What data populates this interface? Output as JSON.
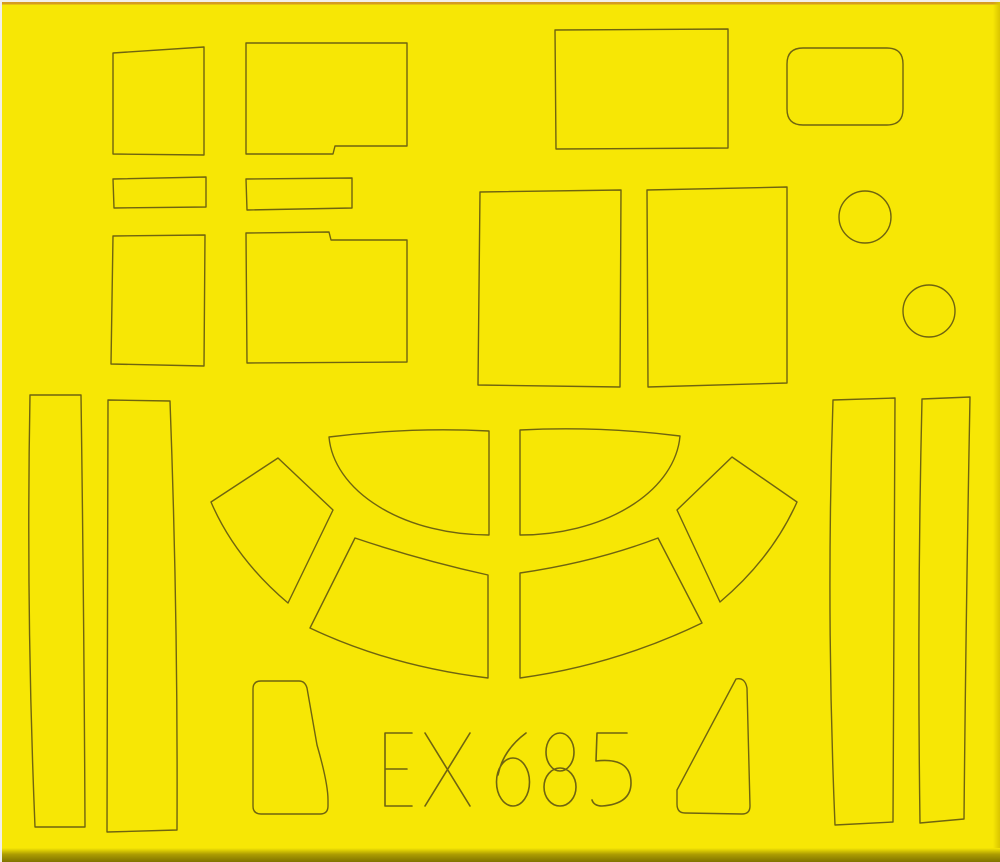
{
  "product_code": "EX685",
  "colors": {
    "background": "#f2efe8",
    "sheet_yellow": "#f7e705",
    "cut_line": "#6f6410",
    "top_accent": "#cd8a26",
    "right_edge_shade": "#d9c500",
    "bottom_edge_mid": "#ac9d02",
    "bottom_edge_dark": "#7f7300"
  },
  "sheet": {
    "width": 1000,
    "height": 862,
    "shapes": [
      {
        "name": "mask-quad-top-left",
        "type": "path",
        "d": "M113,53 L204,47 L204,155 L113,154 Z"
      },
      {
        "name": "mask-rect-notched-top",
        "type": "path",
        "d": "M246,43 L407,43 L407,146 L335,146 L333,154 L246,154 Z"
      },
      {
        "name": "mask-strip-small-left",
        "type": "path",
        "d": "M113,179 L206,177 L206,207 L114,208 Z"
      },
      {
        "name": "mask-strip-small-right",
        "type": "path",
        "d": "M246,179 L352,178 L352,208 L247,210 Z"
      },
      {
        "name": "mask-rect-mid-left",
        "type": "path",
        "d": "M113,236 L205,235 L204,366 L111,364 Z"
      },
      {
        "name": "mask-rect-notched-bottom",
        "type": "path",
        "d": "M246,233 L329,232 L331,240 L407,240 L407,362 L247,363 Z"
      },
      {
        "name": "mask-rect-top-center",
        "type": "path",
        "d": "M555,30 L728,29 L728,148 L556,149 Z"
      },
      {
        "name": "mask-rounded-rect",
        "type": "path",
        "d": "M803,48 L887,48 Q903,48 903,64 L903,109 Q903,125 887,125 L803,125 Q787,125 787,109 L787,64 Q787,48 803,48 Z"
      },
      {
        "name": "mask-rect-center-left",
        "type": "path",
        "d": "M480,192 L621,190 L620,387 L478,385 Z"
      },
      {
        "name": "mask-rect-center-right",
        "type": "path",
        "d": "M647,190 L787,187 L787,383 L648,387 Z"
      },
      {
        "name": "mask-circle-upper",
        "type": "circle",
        "cx": 865,
        "cy": 217,
        "r": 26
      },
      {
        "name": "mask-circle-lower",
        "type": "circle",
        "cx": 929,
        "cy": 311,
        "r": 26
      },
      {
        "name": "mask-canopy-inner-left",
        "type": "path",
        "d": "M329,437 Q409,427 489,431 L489,535 A160,104 0 0 1 329,437 Z"
      },
      {
        "name": "mask-canopy-inner-right",
        "type": "path",
        "d": "M520,430 Q600,426 680,436 A160,105 0 0 1 520,535 Z"
      },
      {
        "name": "mask-canopy-outer-left",
        "type": "path",
        "d": "M355,538 Q420,560 488,575 L488,678 Q390,666 310,628 Z"
      },
      {
        "name": "mask-canopy-outer-right",
        "type": "path",
        "d": "M658,538 Q595,562 520,573 L520,678 Q615,665 702,623 Z"
      },
      {
        "name": "mask-canopy-corner-left",
        "type": "path",
        "d": "M278,458 L211,502 Q235,558 288,603 L333,510 Z"
      },
      {
        "name": "mask-canopy-corner-right",
        "type": "path",
        "d": "M732,457 L797,502 Q772,558 720,602 L677,510 Z"
      },
      {
        "name": "mask-strip-long-left-1",
        "type": "path",
        "d": "M30,395 L81,395 Q84,611 85,827 L35,827 Q26,611 30,395 Z"
      },
      {
        "name": "mask-strip-long-left-2",
        "type": "path",
        "d": "M108,400 L170,401 Q178,615 177,830 L107,832 Q107,616 108,400 Z"
      },
      {
        "name": "mask-strip-long-right-1",
        "type": "path",
        "d": "M833,400 L895,398 Q894,610 893,822 L835,825 Q826,612 833,400 Z"
      },
      {
        "name": "mask-strip-long-right-2",
        "type": "path",
        "d": "M922,399 L970,397 Q966,608 964,819 L920,823 Q917,611 922,399 Z"
      },
      {
        "name": "mask-trapezoid-bottom-left",
        "type": "path",
        "d": "M261,681 L299,681 Q305,681 307,688 L317,745 Q328,783 328,800 L328,806 Q328,814 320,814 L261,814 Q253,814 253,806 L253,689 Q253,681 261,681 Z"
      },
      {
        "name": "mask-trapezoid-bottom-right",
        "type": "path",
        "d": "M736,679 Q745,677 747,688 L750,806 Q750,814 742,814 L685,813 Q677,813 677,804 L677,790 Z"
      },
      {
        "name": "product-code-stroke-E",
        "type": "path",
        "sw": 1.6,
        "d": "M412,733 L385,733 L385,806 L412,806 M385,769 L407,769"
      },
      {
        "name": "product-code-stroke-X",
        "type": "path",
        "sw": 1.6,
        "d": "M425,733 L470,806 M470,733 L425,806"
      },
      {
        "name": "product-code-stroke-6",
        "type": "path",
        "sw": 1.6,
        "d": "M526,733 Q503,750 498,775 M496.5,782 a16.5,24 0 1 0 33,0 a16.5,24 0 1 0 -33,0"
      },
      {
        "name": "product-code-stroke-8",
        "type": "path",
        "sw": 1.6,
        "d": "M546,752 a14,19 0 1 0 28,0 a14,19 0 1 0 -28,0 M544,787 a16,19 0 1 0 32,0 a16,19 0 1 0 -32,0"
      },
      {
        "name": "product-code-stroke-5",
        "type": "path",
        "sw": 1.6,
        "d": "M627,733 L597,733 L596,761 Q631,757 631,783 Q631,804 602,806 Q594,806 592,800"
      }
    ]
  }
}
